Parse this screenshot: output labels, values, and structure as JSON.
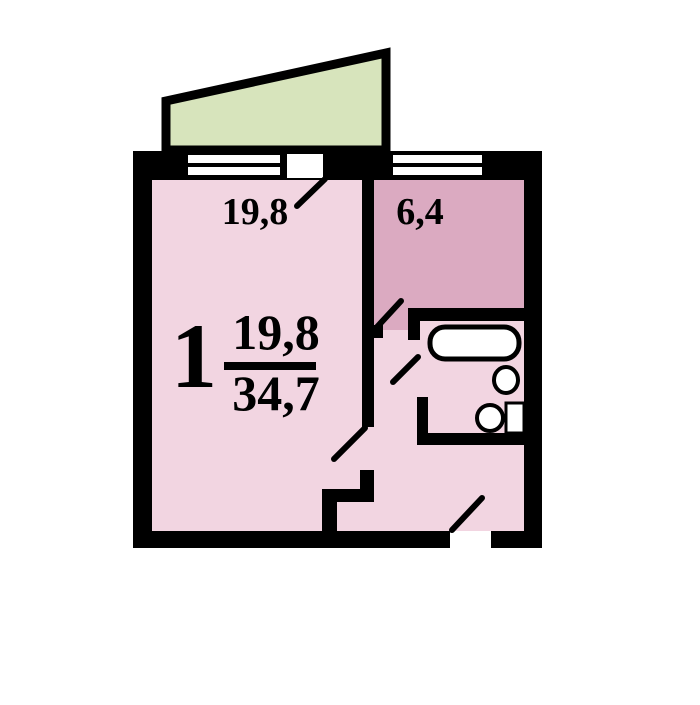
{
  "plan": {
    "title": "1-room apartment floor plan",
    "rooms_count": "1",
    "living_area": "19,8",
    "total_area": "34,7",
    "rooms": [
      {
        "name": "living-room",
        "area_label": "19,8"
      },
      {
        "name": "kitchen",
        "area_label": "6,4"
      }
    ],
    "fixtures": [
      "bathtub",
      "sink",
      "toilet"
    ]
  },
  "colors": {
    "background": "#ffffff",
    "wall": "#000000",
    "room_pink": "#f2d5e1",
    "kitchen_mauve": "#dbaac1",
    "balcony_green": "#d7e4bc",
    "fixture_white": "#ffffff"
  }
}
